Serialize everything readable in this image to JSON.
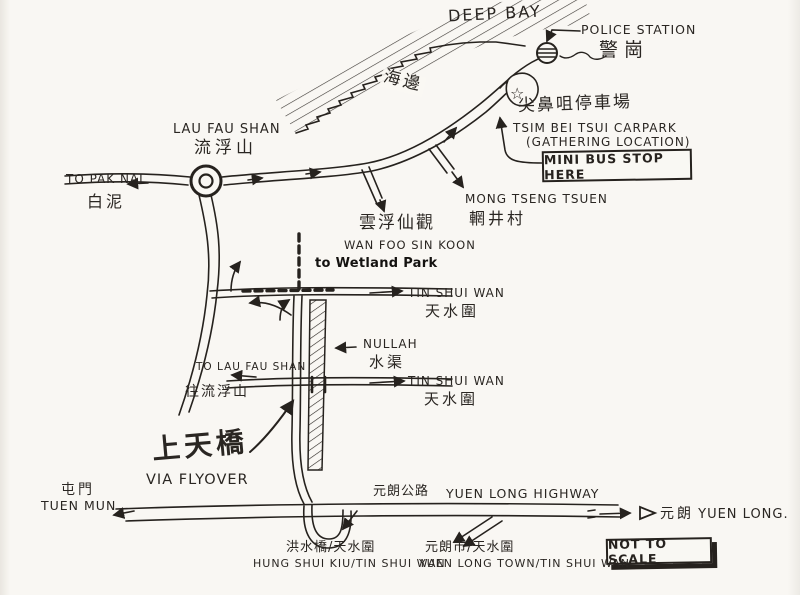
{
  "colors": {
    "ink": "#26221e",
    "paper": "#f9f7f3"
  },
  "map": {
    "sea": {
      "name_en": "DEEP BAY",
      "seaside_zh": "海邊"
    },
    "police_station": {
      "label_en": "POLICE STATION",
      "label_zh": "警崗"
    },
    "carpark": {
      "label_zh": "尖鼻咀停車場",
      "label_en": "TSIM BEI TSUI CARPARK",
      "note": "(GATHERING LOCATION)",
      "minibus_note": "MINI BUS STOP HERE",
      "star_icon": "☆"
    },
    "lau_fau_shan": {
      "label_en": "LAU FAU SHAN",
      "label_zh": "流浮山"
    },
    "pak_nai": {
      "label_en": "TO PAK NAI",
      "label_zh": "白泥"
    },
    "wan_foo_sin_koon": {
      "label_zh": "雲浮仙觀",
      "label_en": "WAN FOO SIN KOON"
    },
    "mong_tseng_tsuen": {
      "label_en": "MONG TSENG TSUEN",
      "label_zh": "輞井村"
    },
    "wetland_park": {
      "label": "to  Wetland Park"
    },
    "tin_shui_wai": {
      "label_en": "TIN SHUI WAN",
      "label_zh": "天水圍"
    },
    "nullah": {
      "label_en": "NULLAH",
      "label_zh": "水渠"
    },
    "to_lau_fau_shan": {
      "label_en": "TO LAU FAU SHAN",
      "label_zh": "往流浮山"
    },
    "flyover": {
      "label_zh": "上天橋",
      "label_en": "VIA FLYOVER"
    },
    "tuen_mun": {
      "label_zh": "屯門",
      "label_en": "TUEN MUN"
    },
    "yuen_long_highway": {
      "label_zh": "元朗公路",
      "label_en": "YUEN LONG HIGHWAY"
    },
    "yuen_long": {
      "label_zh": "元朗",
      "label_en": "YUEN LONG."
    },
    "scale_note": "NOT TO SCALE",
    "exit_hung_shui_kiu": {
      "label_zh": "洪水橋/天水圍",
      "label_en": "HUNG SHUI KIU/TIN SHUI WAN"
    },
    "exit_yuen_long_town": {
      "label_zh": "元朗市/天水圍",
      "label_en": "YUEN LONG TOWN/TIN SHUI WAN"
    }
  }
}
